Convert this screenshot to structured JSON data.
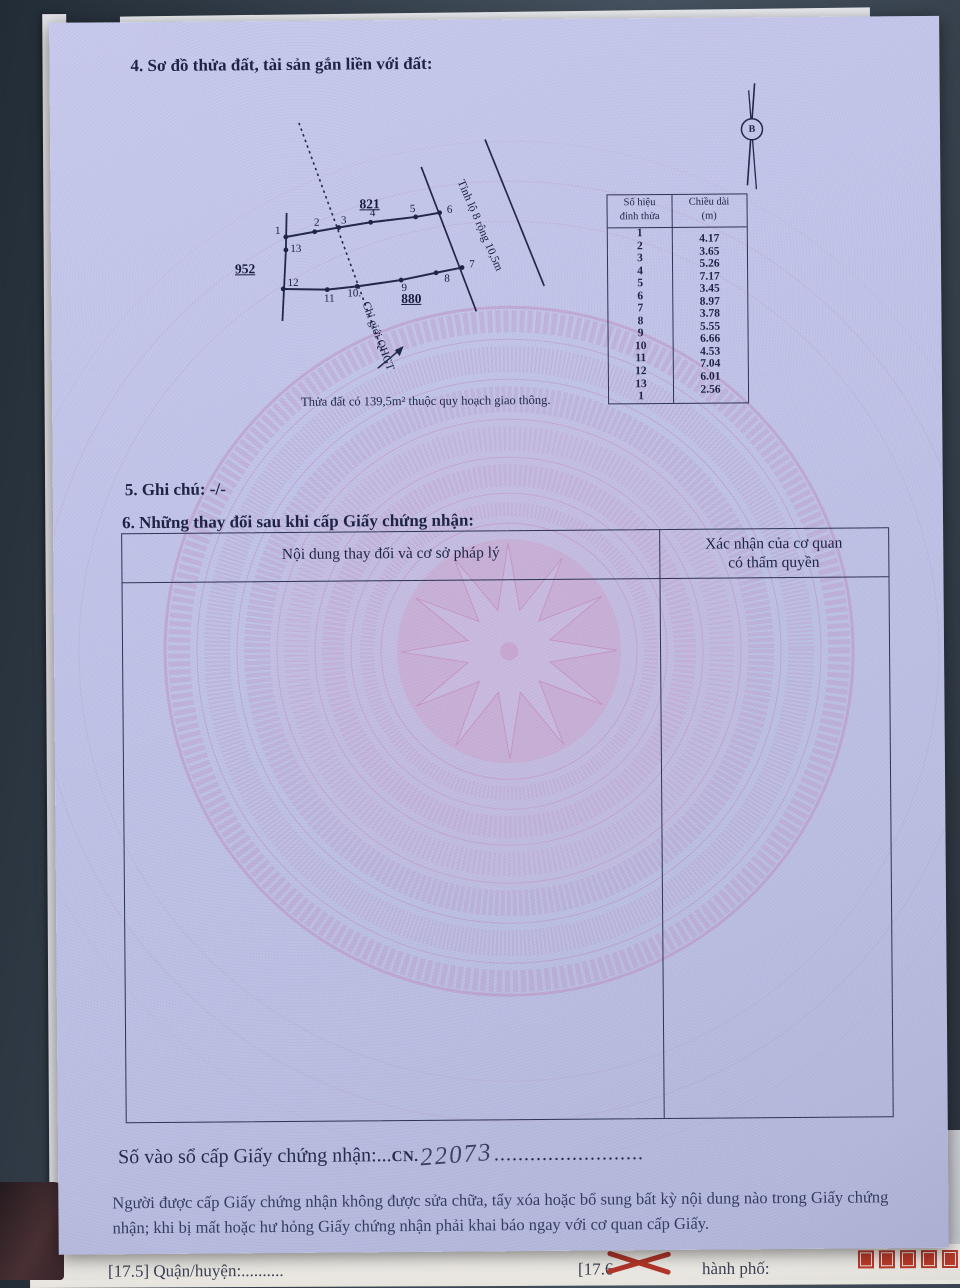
{
  "document": {
    "section4_title": "4. Sơ đồ thửa đất, tài sản gắn liền với đất:",
    "section5_title": "5. Ghi chú: -/-",
    "section6_title": "6. Những thay đổi sau khi cấp Giấy chứng nhận:",
    "note": "Thửa đất có 139,5m² thuộc quy hoạch giao thông.",
    "registry_label": "Số vào sổ cấp Giấy chứng nhận:...",
    "registry_prefix": "CN.",
    "registry_number": "22073",
    "registry_dots": ".........................",
    "footer_line1": "Người được cấp Giấy chứng nhận không được sửa chữa, tẩy xóa hoặc bổ sung bất kỳ nội dung nào trong",
    "footer_line2": "Giấy chứng nhận; khi bị mất hoặc hư hỏng Giấy chứng nhận phải khai báo ngay với cơ quan cấp Giấy."
  },
  "diagram": {
    "north_label": "B",
    "road_label": "Tỉnh lộ 8 rộng 10,5m",
    "boundary_label": "Chỉ giới QHGT",
    "parcel_labels": [
      {
        "text": "821",
        "x": 319,
        "y": 184
      },
      {
        "text": "952",
        "x": 194,
        "y": 248
      },
      {
        "text": "880",
        "x": 360,
        "y": 279
      }
    ],
    "vertices": [
      {
        "n": "1",
        "x": 235,
        "y": 216,
        "cx": 227,
        "cy": 210
      },
      {
        "n": "2",
        "x": 264,
        "y": 211,
        "cx": 266,
        "cy": 202
      },
      {
        "n": "3",
        "x": 288,
        "y": 207,
        "cx": 293,
        "cy": 200
      },
      {
        "n": "4",
        "x": 320,
        "y": 202,
        "cx": 322,
        "cy": 193
      },
      {
        "n": "5",
        "x": 365,
        "y": 197,
        "cx": 362,
        "cy": 189
      },
      {
        "n": "6",
        "x": 389,
        "y": 193,
        "cx": 399,
        "cy": 190
      },
      {
        "n": "7",
        "x": 411,
        "y": 248,
        "cx": 421,
        "cy": 245
      },
      {
        "n": "8",
        "x": 385,
        "y": 253,
        "cx": 396,
        "cy": 259
      },
      {
        "n": "9",
        "x": 350,
        "y": 260,
        "cx": 353,
        "cy": 268
      },
      {
        "n": "10.",
        "x": 306,
        "y": 266,
        "cx": 303,
        "cy": 273
      },
      {
        "n": "11",
        "x": 276,
        "y": 269,
        "cx": 278,
        "cy": 278
      },
      {
        "n": "12",
        "x": 232,
        "y": 268,
        "cx": 242,
        "cy": 262
      },
      {
        "n": "13",
        "x": 235,
        "y": 229,
        "cx": 245,
        "cy": 228
      }
    ]
  },
  "measure_table": {
    "header_col1_line1": "Số hiệu",
    "header_col1_line2": "đỉnh thửa",
    "header_col2_line1": "Chiều dài",
    "header_col2_line2": "(m)",
    "vertex_numbers": [
      "1",
      "2",
      "3",
      "4",
      "5",
      "6",
      "7",
      "8",
      "9",
      "10",
      "11",
      "12",
      "13",
      "1"
    ],
    "lengths": [
      "4.17",
      "3.65",
      "5.26",
      "7.17",
      "3.45",
      "8.97",
      "3.78",
      "5.55",
      "6.66",
      "4.53",
      "7.04",
      "6.01",
      "2.56"
    ]
  },
  "changes_table": {
    "col1_header": "Nội dung thay đổi và cơ sở pháp lý",
    "col2_header_line1": "Xác nhận của cơ quan",
    "col2_header_line2": "có thẩm quyền"
  },
  "under_page": {
    "left_text": "[17.5] Quận/huyện:",
    "left_dots": "..........",
    "mid_text": "[17.6",
    "right_text": "hành phố:"
  },
  "colors": {
    "page": "#c2c5e8",
    "ink": "#1b2142",
    "watermark_pink": "#c090bd",
    "stamp_red": "#b33629"
  }
}
